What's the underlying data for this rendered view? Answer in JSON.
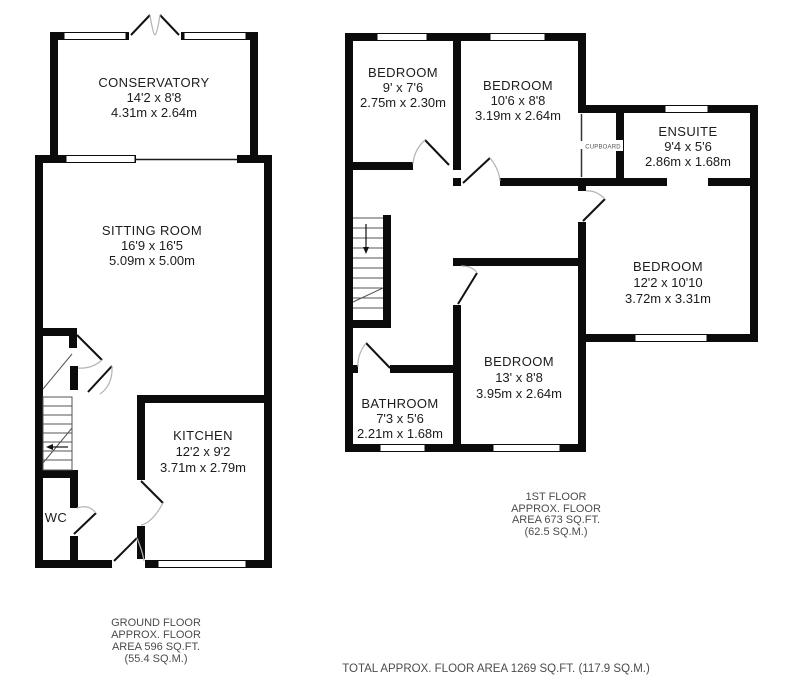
{
  "colors": {
    "wall": "#0b0b0b",
    "background": "#ffffff",
    "room_text": "#1c1c1c",
    "note_text": "#4c4c4c",
    "door_swing": "#b3b3b3"
  },
  "ground_floor": {
    "rooms": {
      "conservatory": {
        "name": "CONSERVATORY",
        "size_imperial": "14'2 x 8'8",
        "size_metric": "4.31m x 2.64m"
      },
      "sitting_room": {
        "name": "SITTING ROOM",
        "size_imperial": "16'9 x 16'5",
        "size_metric": "5.09m x 5.00m"
      },
      "kitchen": {
        "name": "KITCHEN",
        "size_imperial": "12'2 x 9'2",
        "size_metric": "3.71m x 2.79m"
      },
      "wc": {
        "name": "WC"
      }
    },
    "label": {
      "line1": "GROUND FLOOR",
      "line2": "APPROX. FLOOR",
      "line3": "AREA 596 SQ.FT.",
      "line4": "(55.4 SQ.M.)"
    }
  },
  "first_floor": {
    "rooms": {
      "bedroom_front_left": {
        "name": "BEDROOM",
        "size_imperial": "9' x 7'6",
        "size_metric": "2.75m x 2.30m"
      },
      "bedroom_front_mid": {
        "name": "BEDROOM",
        "size_imperial": "10'6 x 8'8",
        "size_metric": "3.19m x 2.64m"
      },
      "ensuite": {
        "name": "ENSUITE",
        "size_imperial": "9'4 x 5'6",
        "size_metric": "2.86m x 1.68m"
      },
      "bedroom_right": {
        "name": "BEDROOM",
        "size_imperial": "12'2 x 10'10",
        "size_metric": "3.72m x 3.31m"
      },
      "bedroom_rear": {
        "name": "BEDROOM",
        "size_imperial": "13' x 8'8",
        "size_metric": "3.95m x 2.64m"
      },
      "bathroom": {
        "name": "BATHROOM",
        "size_imperial": "7'3 x 5'6",
        "size_metric": "2.21m x 1.68m"
      },
      "cupboard": {
        "name": "CUPBOARD"
      }
    },
    "label": {
      "line1": "1ST FLOOR",
      "line2": "APPROX. FLOOR",
      "line3": "AREA 673 SQ.FT.",
      "line4": "(62.5 SQ.M.)"
    }
  },
  "total_area": "TOTAL APPROX. FLOOR AREA 1269 SQ.FT. (117.9 SQ.M.)"
}
